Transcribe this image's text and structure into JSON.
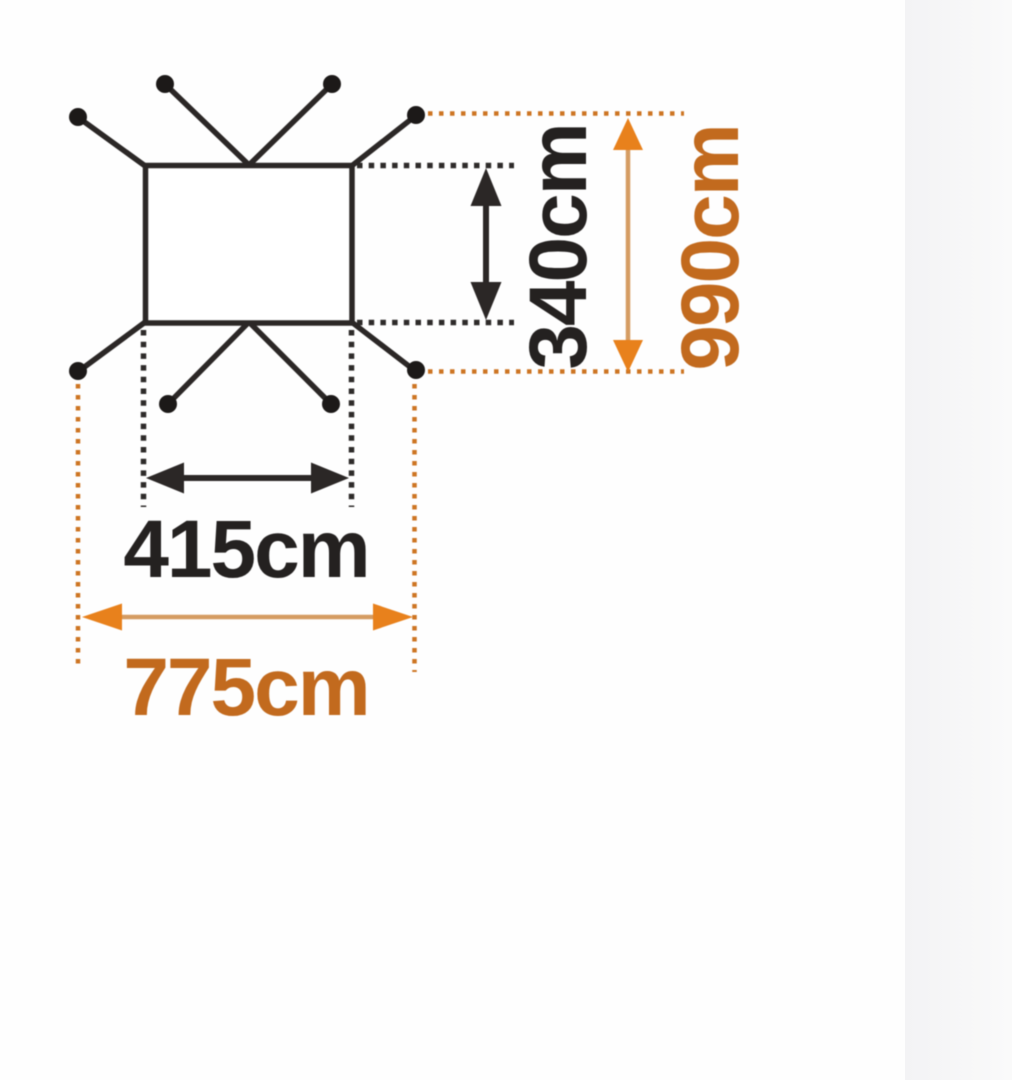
{
  "page": {
    "colors": {
      "background": "#fefefe",
      "strip_left": "#f3f3f5",
      "strip_right": "#fafafa"
    }
  },
  "diagram": {
    "type": "tarp-footprint-dimension-diagram",
    "labels": {
      "inner_width": "415cm",
      "inner_depth": "340cm",
      "outer_width": "775cm",
      "outer_depth": "990cm"
    },
    "dimensions_cm": {
      "inner_width": 415,
      "inner_depth": 340,
      "outer_width": 775,
      "outer_depth": 990
    },
    "colors": {
      "line_black": "#2b2726",
      "dot_black": "#1c1918",
      "text_black": "#242120",
      "dotted_black": "#2e2b2a",
      "orange_dotted": "#cd7523",
      "orange_text": "#c26a1e",
      "orange_head": "#e8811c",
      "arrow_shaft_tan": "#d59c62"
    }
  }
}
